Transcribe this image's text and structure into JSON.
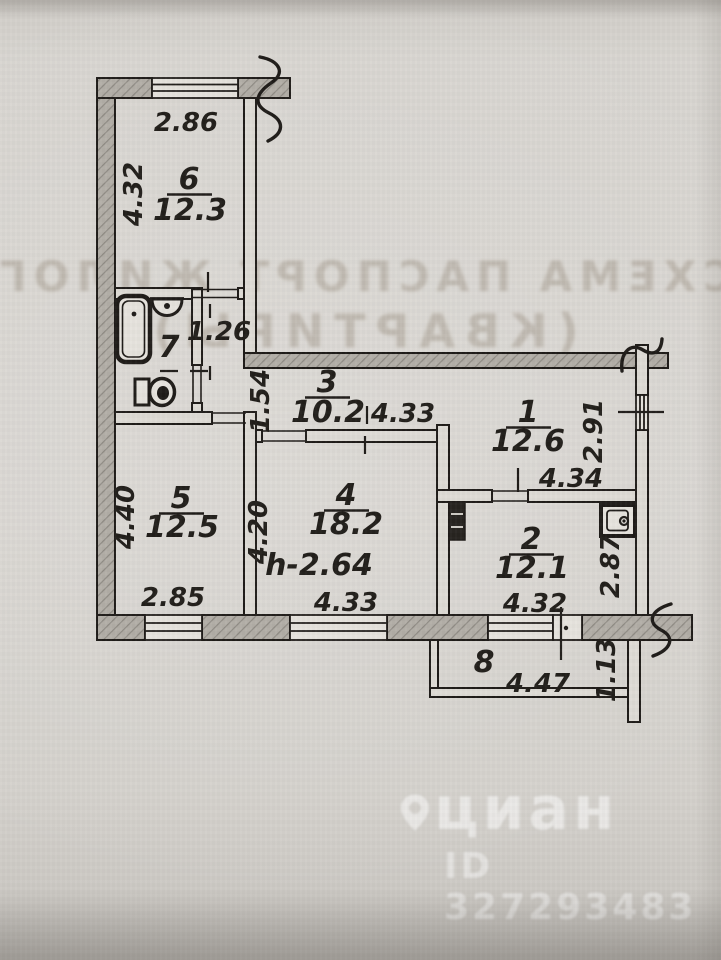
{
  "bleedthrough": {
    "line1": "СХЕМА ПАСПОРТ ЖИЛОГО ПОМЕЩЕНИЯ",
    "line2": "(КВАРТИРЫ)"
  },
  "watermark": {
    "brand": "циан",
    "id": "ID 327293483"
  },
  "plan": {
    "rooms": {
      "r1": {
        "number": "1",
        "area": "12.6",
        "dim_bottom": "4.34",
        "dim_right": "2.91"
      },
      "r2": {
        "number": "2",
        "area": "12.1",
        "dim_bottom": "4.32",
        "dim_right": "2.87"
      },
      "r3": {
        "number": "3",
        "area": "10.2",
        "dim_left": "1.54",
        "dim_bottom": "4.33"
      },
      "r4": {
        "number": "4",
        "area": "18.2",
        "dim_left": "4.20",
        "dim_bottom": "4.33",
        "ceiling_height": "h-2.64"
      },
      "r5": {
        "number": "5",
        "area": "12.5",
        "dim_left": "4.40",
        "dim_bottom": "2.85"
      },
      "r6": {
        "number": "6",
        "area": "12.3",
        "dim_top": "2.86",
        "dim_left": "4.32"
      },
      "r7": {
        "number": "7",
        "dim_right": "1.26"
      },
      "r8": {
        "number": "8",
        "dim_bottom": "4.47",
        "dim_right": "1.13"
      }
    }
  }
}
